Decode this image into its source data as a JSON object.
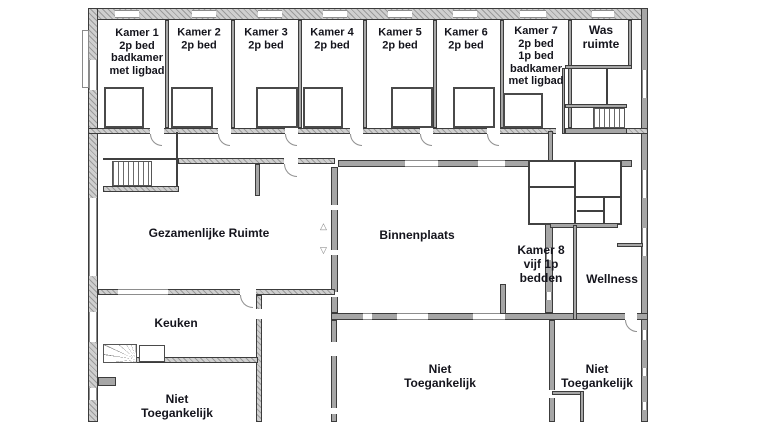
{
  "rooms": {
    "kamer1": "Kamer 1\n2p bed\nbadkamer\nmet ligbad",
    "kamer2": "Kamer 2\n2p bed",
    "kamer3": "Kamer 3\n2p bed",
    "kamer4": "Kamer 4\n2p bed",
    "kamer5": "Kamer 5\n2p bed",
    "kamer6": "Kamer 6\n2p bed",
    "kamer7": "Kamer 7\n2p bed\n1p bed\nbadkamer\nmet ligbad",
    "was_ruimte": "Was\nruimte",
    "gezamenlijke_ruimte": "Gezamenlijke Ruimte",
    "binnenplaats": "Binnenplaats",
    "kamer8": "Kamer 8\nvijf 1p\nbedden",
    "wellness": "Wellness",
    "keuken": "Keuken",
    "niet_toegankelijk_links": "Niet\nToegankelijk",
    "niet_toegankelijk_midden": "Niet\nToegankelijk",
    "niet_toegankelijk_rechts": "Niet\nToegankelijk"
  },
  "colors": {
    "wall": "#a6a6a6",
    "wall_outline": "#3c3c3c",
    "text": "#14141c",
    "background": "#ffffff"
  }
}
